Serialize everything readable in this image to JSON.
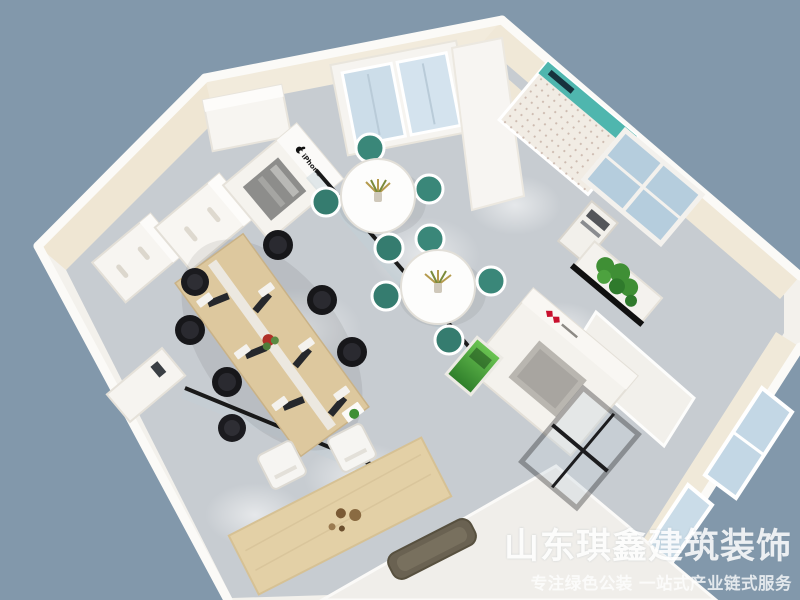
{
  "meta": {
    "type": "3d-interior-render",
    "description": "Bird's-eye 3D rendering of an office / phone-store interior with workstations, lounge tables and brand display fixtures"
  },
  "watermark": {
    "title": "山东琪鑫建筑装饰",
    "subtitle": "专注绿色公装  一站式产业链式服务"
  },
  "labels": {
    "iphone_display": "iPhone"
  },
  "palette": {
    "background": "#8298ab",
    "floor": "#c7ccd1",
    "wall_cream": "#efe6d3",
    "wall_white": "#f5f3ef",
    "wood": "#ddc89e",
    "chair_black": "#1a1a1e",
    "chair_teal": "#3a8779",
    "glass_blue": "#bdd2e0",
    "accent_red": "#c8102e",
    "plant_green": "#3f8f35",
    "bench_brown": "#6a6252"
  },
  "objects": [
    {
      "name": "office-workstation-desk",
      "desc": "long light-wood desk with monitors, keyboards, red plant centerpiece and six black office chairs"
    },
    {
      "name": "round-meeting-tables",
      "desc": "two white round tables, each with a plant centerpiece and four teal-cushion chairs"
    },
    {
      "name": "iphone-display-cabinet",
      "desc": "white display cabinet with Apple logo and iPhone lettering"
    },
    {
      "name": "filing-cabinets",
      "desc": "white drawer cabinets along the beige wall"
    },
    {
      "name": "accessory-pegboard-wall",
      "desc": "perforated accessory display wall with teal header strip"
    },
    {
      "name": "double-glass-door",
      "desc": "white-framed double glass door on the top wall"
    },
    {
      "name": "brand-reception-block",
      "desc": "white reception structure with red brand logo and green display stand"
    },
    {
      "name": "self-service-kiosk",
      "desc": "white kiosk machine beside the window"
    },
    {
      "name": "window-planter",
      "desc": "green plant in a white planter box under the window"
    },
    {
      "name": "glass-partitions",
      "desc": "black-framed glass partition walls"
    },
    {
      "name": "bar-counter",
      "desc": "wooden bar counter with tea set and two white chairs"
    },
    {
      "name": "bench",
      "desc": "dark wooden bench on a white platform"
    },
    {
      "name": "entrance-glass-door",
      "desc": "black-framed glass entrance door"
    },
    {
      "name": "corner-windows",
      "desc": "blue glass windows on the right walls"
    }
  ]
}
